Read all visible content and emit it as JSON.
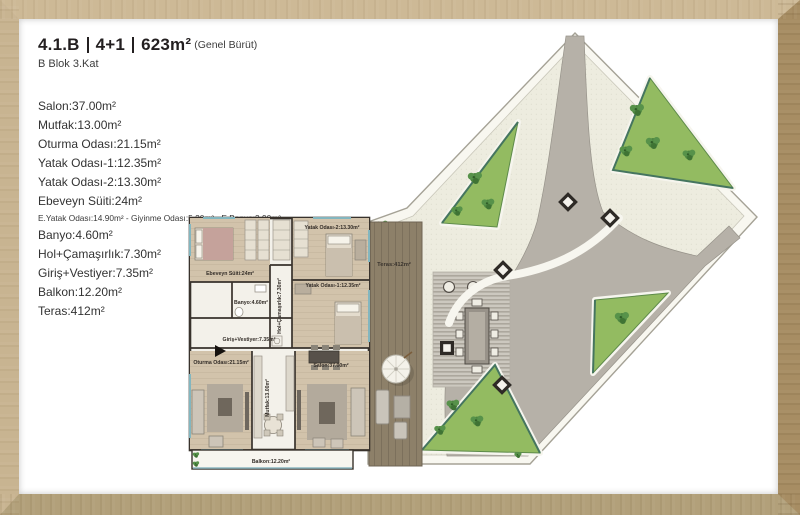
{
  "header": {
    "unit": "4.1.B",
    "rooms": "4+1",
    "gross_area": "623m²",
    "gross_area_note": "(Genel Bürüt)",
    "block_floor": "B Blok 3.Kat"
  },
  "area_list": {
    "items": [
      "Salon:37.00m²",
      "Mutfak:13.00m²",
      "Oturma Odası:21.15m²",
      "Yatak Odası-1:12.35m²",
      "Yatak Odası-2:13.30m²",
      "Ebeveyn Süiti:24m²"
    ],
    "suite_detail": "E.Yatak Odası:14.90m² - Giyinme Odası:5.20m² - E.Banyo:3.90m²",
    "items2": [
      "Banyo:4.60m²",
      "Hol+Çamaşırlık:7.30m²",
      "Giriş+Vestiyer:7.35m²",
      "Balkon:12.20m²",
      "Teras:412m²"
    ]
  },
  "plan_labels": {
    "ebeveyn": "Ebeveyn Süiti:24m²",
    "banyo": "Banyo:4.60m²",
    "hol": "Hol+Çamaşırlık:7.30m²",
    "yatak2": "Yatak Odası-2:13.30m²",
    "yatak1": "Yatak Odası-1:12.35m²",
    "giris": "Giriş+Vestiyer:7.35m²",
    "oturma": "Oturma Odası:21.15m²",
    "mutfak": "Mutfak:13.00m²",
    "salon": "Salon:37.00m²",
    "balkon": "Balkon:12.20m²",
    "teras": "Teras:412m²"
  },
  "colors": {
    "frame_wood": "#c8b491",
    "frame_wood_dark": "#a78d63",
    "wall": "#38322c",
    "wood_floor": "#d2c3ab",
    "white_floor": "#f3f1ea",
    "lawn": "#93bb61",
    "tree": "#4d8540",
    "road_grey": "#b6b1a8",
    "paving": "#edecdf",
    "deck_brown": "#8d8069",
    "window_teal": "#83b6bf"
  }
}
